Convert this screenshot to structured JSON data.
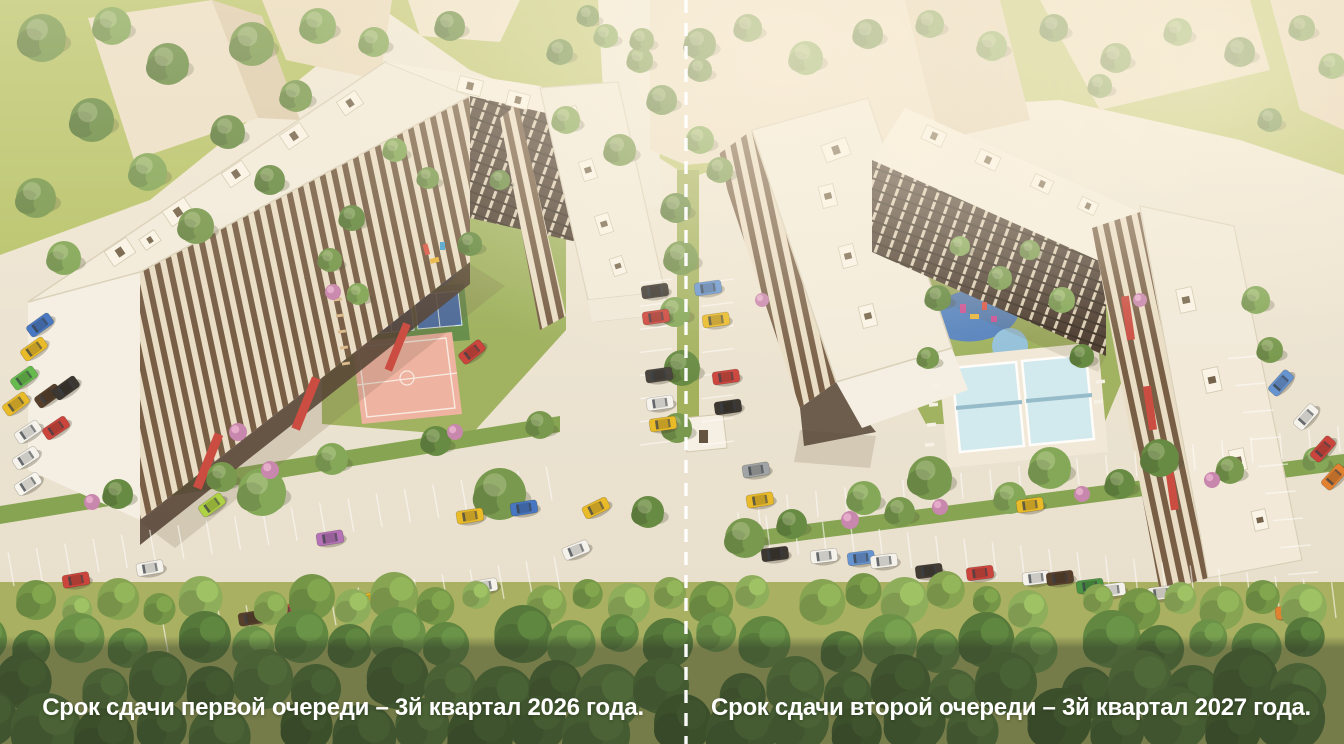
{
  "captions": {
    "left": "Срок сдачи первой очереди – 3й квартал 2026 года.",
    "right": "Срок сдачи второй очереди – 3й квартал 2027 года."
  },
  "divider": {
    "style": "dashed",
    "color": "#ffffff"
  },
  "palette": {
    "pavement": "#ece5d7",
    "grass": "#b4c266",
    "grass_dark": "#9ab05c",
    "hedge": "#7da04b",
    "roof": "#f2ecdf",
    "gable": "#f4f0e7",
    "facade_cream": "#e8ddc8",
    "facade_brown": "#6d543e",
    "facade_dark": "#42332a",
    "accent_red": "#c7423a",
    "court_pink": "#eeb0a1",
    "court_blue": "#3a67ad",
    "playground_blue": "#4d7ec0",
    "pool_blue": "#cfeaf4",
    "bg_building": "#e9ddc6",
    "overlay_band": "#31392b",
    "caption_text": "#ffffff",
    "forest_dark": "#3f6329",
    "forest_light": "#7da04b"
  },
  "scene": {
    "tree_colors": [
      "#6f9448",
      "#5d853c",
      "#7ba352",
      "#557a38",
      "#86ad5b"
    ],
    "trees": [
      [
        42,
        38,
        24,
        0
      ],
      [
        112,
        26,
        19,
        2
      ],
      [
        168,
        64,
        21,
        1
      ],
      [
        252,
        44,
        22,
        0
      ],
      [
        318,
        26,
        18,
        2
      ],
      [
        92,
        120,
        22,
        1
      ],
      [
        36,
        198,
        20,
        0
      ],
      [
        148,
        172,
        19,
        2
      ],
      [
        228,
        132,
        17,
        1
      ],
      [
        296,
        96,
        16,
        0
      ],
      [
        374,
        42,
        15,
        2
      ],
      [
        450,
        26,
        15,
        1
      ],
      [
        64,
        258,
        17,
        2
      ],
      [
        196,
        226,
        18,
        0
      ],
      [
        270,
        180,
        15,
        1
      ],
      [
        560,
        52,
        13,
        1
      ],
      [
        606,
        36,
        12,
        2
      ],
      [
        640,
        60,
        13,
        0
      ],
      [
        588,
        16,
        11,
        1
      ],
      [
        566,
        120,
        14,
        2
      ],
      [
        620,
        150,
        16,
        0
      ],
      [
        662,
        100,
        15,
        1
      ],
      [
        700,
        140,
        14,
        2
      ],
      [
        642,
        40,
        12,
        0
      ],
      [
        700,
        70,
        12,
        1
      ],
      [
        720,
        170,
        13,
        0
      ],
      [
        676,
        208,
        15,
        1
      ],
      [
        681,
        258,
        17,
        0
      ],
      [
        675,
        312,
        15,
        2
      ],
      [
        682,
        368,
        18,
        1
      ],
      [
        677,
        428,
        15,
        0
      ],
      [
        118,
        494,
        15,
        1
      ],
      [
        222,
        477,
        15,
        0
      ],
      [
        332,
        459,
        16,
        2
      ],
      [
        436,
        441,
        15,
        1
      ],
      [
        540,
        425,
        14,
        0
      ],
      [
        262,
        492,
        24,
        2
      ],
      [
        500,
        494,
        26,
        0
      ],
      [
        648,
        512,
        16,
        1
      ],
      [
        352,
        218,
        13,
        1
      ],
      [
        330,
        260,
        12,
        0
      ],
      [
        358,
        294,
        11,
        2
      ],
      [
        470,
        244,
        12,
        1
      ],
      [
        428,
        178,
        11,
        0
      ],
      [
        395,
        150,
        12,
        2
      ],
      [
        500,
        180,
        10,
        1
      ],
      [
        938,
        298,
        13,
        1
      ],
      [
        1000,
        278,
        12,
        0
      ],
      [
        1062,
        300,
        13,
        2
      ],
      [
        928,
        358,
        11,
        0
      ],
      [
        1082,
        356,
        12,
        1
      ],
      [
        960,
        246,
        10,
        2
      ],
      [
        1030,
        250,
        10,
        0
      ],
      [
        792,
        524,
        15,
        1
      ],
      [
        900,
        512,
        15,
        0
      ],
      [
        1010,
        498,
        16,
        2
      ],
      [
        1120,
        484,
        15,
        1
      ],
      [
        1230,
        470,
        14,
        0
      ],
      [
        1316,
        460,
        13,
        2
      ],
      [
        930,
        478,
        22,
        0
      ],
      [
        1050,
        468,
        21,
        2
      ],
      [
        1160,
        458,
        19,
        1
      ],
      [
        745,
        538,
        20,
        0
      ],
      [
        864,
        498,
        17,
        2
      ],
      [
        700,
        44,
        16,
        1
      ],
      [
        748,
        28,
        14,
        0
      ],
      [
        806,
        58,
        17,
        2
      ],
      [
        868,
        34,
        15,
        1
      ],
      [
        930,
        24,
        14,
        0
      ],
      [
        992,
        46,
        15,
        2
      ],
      [
        1054,
        28,
        14,
        1
      ],
      [
        1116,
        58,
        15,
        0
      ],
      [
        1178,
        32,
        14,
        2
      ],
      [
        1240,
        52,
        15,
        1
      ],
      [
        1302,
        28,
        13,
        0
      ],
      [
        1332,
        66,
        13,
        2
      ],
      [
        1270,
        120,
        12,
        1
      ],
      [
        1100,
        86,
        12,
        0
      ],
      [
        1256,
        300,
        14,
        2
      ],
      [
        1270,
        350,
        13,
        0
      ]
    ],
    "bushes": [
      [
        270,
        470,
        9
      ],
      [
        92,
        502,
        8
      ],
      [
        850,
        520,
        9
      ],
      [
        1082,
        494,
        8
      ],
      [
        1212,
        480,
        8
      ],
      [
        455,
        432,
        8
      ],
      [
        940,
        507,
        8
      ],
      [
        333,
        292,
        8
      ],
      [
        238,
        432,
        9
      ],
      [
        762,
        300,
        7
      ],
      [
        1140,
        300,
        7
      ]
    ],
    "cars": [
      [
        40,
        325,
        -36,
        "#3a6fc4"
      ],
      [
        34,
        349,
        -36,
        "#e8b820"
      ],
      [
        24,
        378,
        -36,
        "#5cb847"
      ],
      [
        16,
        404,
        -36,
        "#e8b820"
      ],
      [
        48,
        396,
        -36,
        "#4a3322"
      ],
      [
        66,
        388,
        -36,
        "#2e2a28"
      ],
      [
        28,
        432,
        -34,
        "#f4f4f0"
      ],
      [
        56,
        428,
        -34,
        "#c93a35"
      ],
      [
        26,
        458,
        -33,
        "#f4f4f0"
      ],
      [
        28,
        484,
        -33,
        "#f7f7f3"
      ],
      [
        212,
        505,
        -36,
        "#a8d13c"
      ],
      [
        472,
        352,
        -38,
        "#c93a35"
      ],
      [
        596,
        508,
        -26,
        "#e8b820"
      ],
      [
        576,
        550,
        -22,
        "#f4f4f0"
      ],
      [
        76,
        580,
        -10,
        "#c93a35"
      ],
      [
        150,
        568,
        -10,
        "#f4f4f0"
      ],
      [
        330,
        538,
        -9,
        "#b06ab8"
      ],
      [
        470,
        516,
        -9,
        "#e8b820"
      ],
      [
        524,
        508,
        -9,
        "#3a6fc4"
      ],
      [
        252,
        618,
        -9,
        "#4a3322"
      ],
      [
        283,
        612,
        -9,
        "#c93a35"
      ],
      [
        366,
        600,
        -9,
        "#e8b820"
      ],
      [
        398,
        596,
        -9,
        "#6b4a32"
      ],
      [
        484,
        586,
        -9,
        "#f4f4f0"
      ],
      [
        655,
        291,
        -8,
        "#2e2a28"
      ],
      [
        656,
        317,
        -8,
        "#c93a35"
      ],
      [
        659,
        375,
        -8,
        "#3c3835"
      ],
      [
        660,
        403,
        -8,
        "#f4f4f0"
      ],
      [
        663,
        424,
        -8,
        "#e8b820"
      ],
      [
        708,
        288,
        -8,
        "#5b8fd4"
      ],
      [
        716,
        320,
        -8,
        "#e8b820"
      ],
      [
        726,
        377,
        -8,
        "#c93a35"
      ],
      [
        728,
        407,
        -8,
        "#2e2a28"
      ],
      [
        775,
        554,
        -7,
        "#2e2a28"
      ],
      [
        824,
        556,
        -7,
        "#f4f4f0"
      ],
      [
        861,
        558,
        -7,
        "#5b8fd4"
      ],
      [
        884,
        561,
        -7,
        "#f4f4f0"
      ],
      [
        929,
        571,
        -7,
        "#35302c"
      ],
      [
        980,
        573,
        -7,
        "#c93a35"
      ],
      [
        1036,
        578,
        -7,
        "#f4f4f0"
      ],
      [
        1060,
        578,
        -7,
        "#4a3322"
      ],
      [
        1090,
        586,
        -7,
        "#3f8f3c"
      ],
      [
        1112,
        590,
        -7,
        "#f4f4f0"
      ],
      [
        1161,
        593,
        -7,
        "#eceae4"
      ],
      [
        1218,
        603,
        -7,
        "#e8b820"
      ],
      [
        1289,
        612,
        -7,
        "#e07b28"
      ],
      [
        1030,
        505,
        -8,
        "#e8b820"
      ],
      [
        756,
        470,
        -9,
        "#9aa0a4"
      ],
      [
        760,
        500,
        -9,
        "#e8b820"
      ],
      [
        1281,
        383,
        -48,
        "#5b8fd4"
      ],
      [
        1306,
        417,
        -48,
        "#f4f4f0"
      ],
      [
        1323,
        449,
        -48,
        "#c93a35"
      ],
      [
        1334,
        477,
        -48,
        "#e07b28"
      ]
    ],
    "stall_rows": [
      {
        "a": [
          14,
          586
        ],
        "b": [
          552,
          500
        ],
        "n": 19,
        "len": 34,
        "ang": -100
      },
      {
        "a": [
          168,
          652
        ],
        "b": [
          560,
          590
        ],
        "n": 14,
        "len": 34,
        "ang": -100
      },
      {
        "a": [
          742,
          548
        ],
        "b": [
          1336,
          618
        ],
        "n": 21,
        "len": 36,
        "ang": -97
      },
      {
        "a": [
          760,
          524
        ],
        "b": [
          1340,
          452
        ],
        "n": 20,
        "len": 26,
        "ang": -95
      },
      {
        "a": [
          640,
          283
        ],
        "b": [
          640,
          445
        ],
        "n": 7,
        "len": 32,
        "ang": -7
      },
      {
        "a": [
          702,
          283
        ],
        "b": [
          702,
          445
        ],
        "n": 7,
        "len": 32,
        "ang": -7
      },
      {
        "a": [
          1258,
          356
        ],
        "b": [
          1318,
          572
        ],
        "n": 8,
        "len": 30,
        "ang": 175
      }
    ],
    "roof_boxes": [
      [
        120,
        252,
        26,
        18,
        -34
      ],
      [
        178,
        212,
        26,
        18,
        -34
      ],
      [
        236,
        174,
        24,
        17,
        -34
      ],
      [
        294,
        136,
        24,
        17,
        -34
      ],
      [
        350,
        103,
        22,
        16,
        -34
      ],
      [
        150,
        240,
        18,
        13,
        -34
      ],
      [
        470,
        86,
        24,
        16,
        14
      ],
      [
        518,
        100,
        22,
        15,
        14
      ],
      [
        572,
        118,
        22,
        15,
        72
      ],
      [
        588,
        170,
        20,
        14,
        72
      ],
      [
        604,
        224,
        20,
        14,
        72
      ],
      [
        618,
        266,
        18,
        13,
        72
      ],
      [
        836,
        150,
        26,
        18,
        -20
      ],
      [
        828,
        196,
        22,
        15,
        76
      ],
      [
        848,
        256,
        22,
        15,
        76
      ],
      [
        868,
        316,
        22,
        15,
        76
      ],
      [
        934,
        136,
        22,
        15,
        25
      ],
      [
        988,
        160,
        22,
        15,
        25
      ],
      [
        1042,
        184,
        20,
        14,
        25
      ],
      [
        1088,
        206,
        18,
        13,
        25
      ],
      [
        1186,
        300,
        24,
        16,
        78
      ],
      [
        1212,
        380,
        24,
        16,
        78
      ],
      [
        1238,
        460,
        22,
        15,
        78
      ],
      [
        1260,
        520,
        20,
        14,
        78
      ]
    ],
    "forest_rows": [
      {
        "y": 600,
        "r": 19,
        "n": 30,
        "shades": [
          "#7da04b",
          "#6b9140",
          "#87ab55"
        ]
      },
      {
        "y": 642,
        "r": 24,
        "n": 26,
        "shades": [
          "#55803a",
          "#4a7233",
          "#618c41"
        ]
      },
      {
        "y": 688,
        "r": 28,
        "n": 24,
        "shades": [
          "#466d2f",
          "#3d6129",
          "#527a37"
        ]
      },
      {
        "y": 728,
        "r": 30,
        "n": 22,
        "shades": [
          "#3f6329",
          "#486f30",
          "#365723"
        ]
      }
    ]
  }
}
